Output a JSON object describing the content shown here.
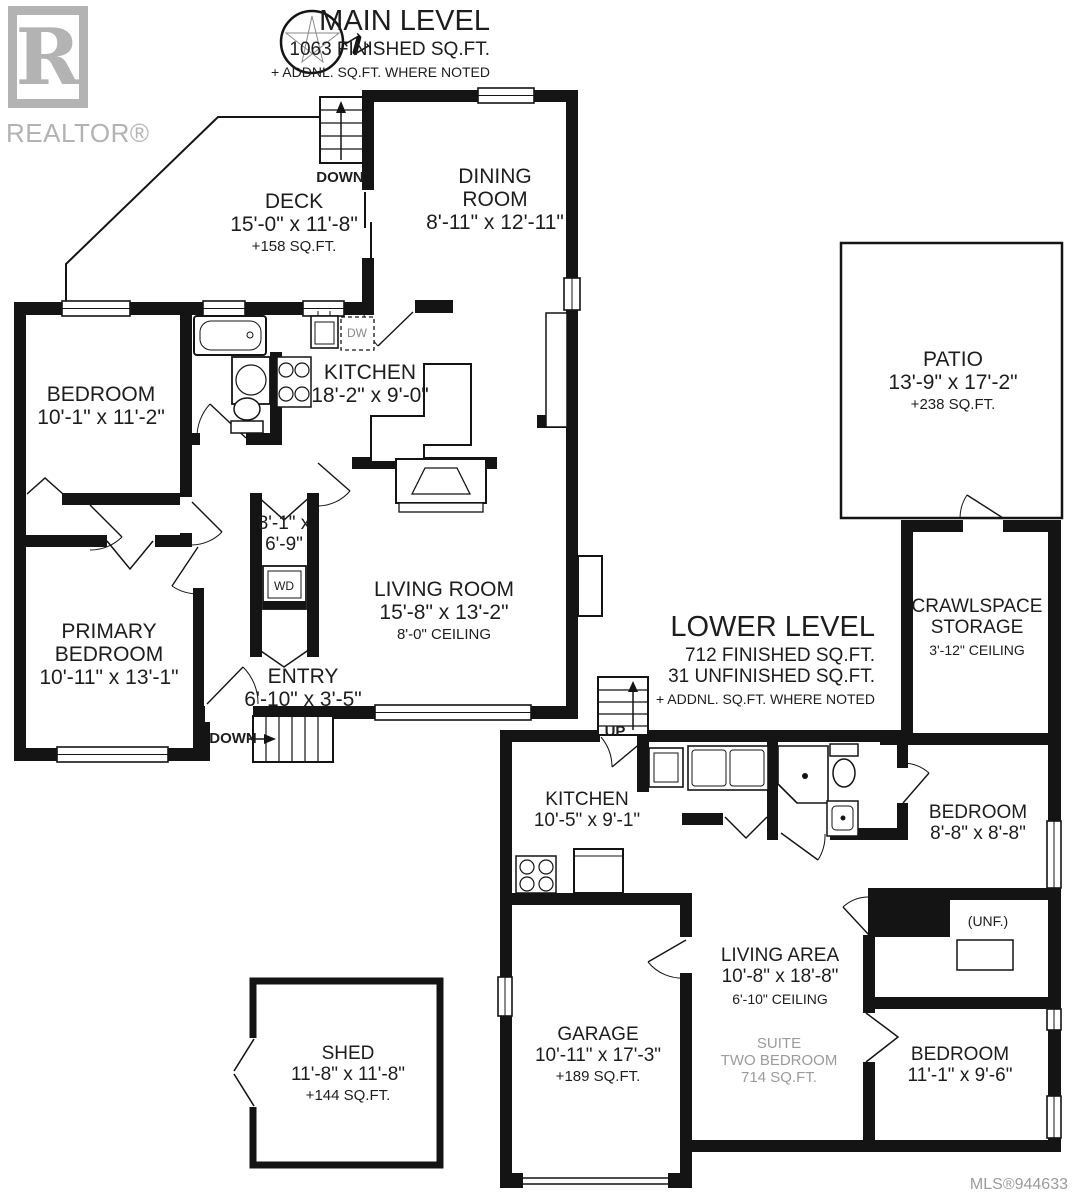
{
  "colors": {
    "ink": "#141414",
    "muted_grey": "#9b9b9b",
    "logo_grey": "#b3b3b3"
  },
  "branding": {
    "logo_letter": "R",
    "logo_text": "REALTOR®",
    "mls": "MLS®944633"
  },
  "compass": {
    "north": "N"
  },
  "main_level": {
    "title": "MAIN LEVEL",
    "area": "1063 FINISHED SQ.FT.",
    "note": "+ ADDNL. SQ.FT. WHERE NOTED",
    "stairs_top_label": "DOWN",
    "stairs_entry_label": "DOWN",
    "rooms": {
      "deck": {
        "name": "DECK",
        "dims": "15'-0\" x 11'-8\"",
        "area": "+158 SQ.FT."
      },
      "dining": {
        "name_line1": "DINING",
        "name_line2": "ROOM",
        "dims": "8'-11\" x 12'-11\""
      },
      "bedroom": {
        "name": "BEDROOM",
        "dims": "10'-1\" x 11'-2\""
      },
      "kitchen": {
        "name": "KITCHEN",
        "dims": "18'-2\" x 9'-0\""
      },
      "laundry_closet": {
        "dims_line1": "3'-1\" x",
        "dims_line2": "6'-9\""
      },
      "living_room": {
        "name": "LIVING ROOM",
        "dims": "15'-8\" x 13'-2\"",
        "ceiling": "8'-0\" CEILING"
      },
      "primary": {
        "name_line1": "PRIMARY",
        "name_line2": "BEDROOM",
        "dims": "10'-11\" x 13'-1\""
      },
      "entry": {
        "name": "ENTRY",
        "dims": "6'-10\" x 3'-5\""
      }
    },
    "appliances": {
      "dishwasher": "DW",
      "washer_dryer": "WD"
    }
  },
  "exterior": {
    "patio": {
      "name": "PATIO",
      "dims": "13'-9\" x 17'-2\"",
      "area": "+238 SQ.FT."
    },
    "shed": {
      "name": "SHED",
      "dims": "11'-8\" x 11'-8\"",
      "area": "+144 SQ.FT."
    }
  },
  "lower_level": {
    "title": "LOWER LEVEL",
    "area": "712 FINISHED SQ.FT.",
    "area2": "31 UNFINISHED SQ.FT.",
    "note": "+ ADDNL. SQ.FT. WHERE NOTED",
    "stairs_label": "UP",
    "rooms": {
      "crawlspace": {
        "name_line1": "CRAWLSPACE",
        "name_line2": "STORAGE",
        "ceiling": "3'-12\" CEILING"
      },
      "kitchen": {
        "name": "KITCHEN",
        "dims": "10'-5\" x 9'-1\""
      },
      "bedroom_one": {
        "name": "BEDROOM",
        "dims": "8'-8\" x 8'-8\""
      },
      "unfinished": {
        "label": "(UNF.)"
      },
      "living_area": {
        "name": "LIVING AREA",
        "dims": "10'-8\" x 18'-8\"",
        "ceiling": "6'-10\" CEILING"
      },
      "suite_note": {
        "line1": "SUITE",
        "line2": "TWO BEDROOM",
        "line3": "714 SQ.FT."
      },
      "garage": {
        "name": "GARAGE",
        "dims": "10'-11\" x 17'-3\"",
        "area": "+189 SQ.FT."
      },
      "bedroom_two": {
        "name": "BEDROOM",
        "dims": "11'-1\" x 9'-6\""
      }
    }
  }
}
